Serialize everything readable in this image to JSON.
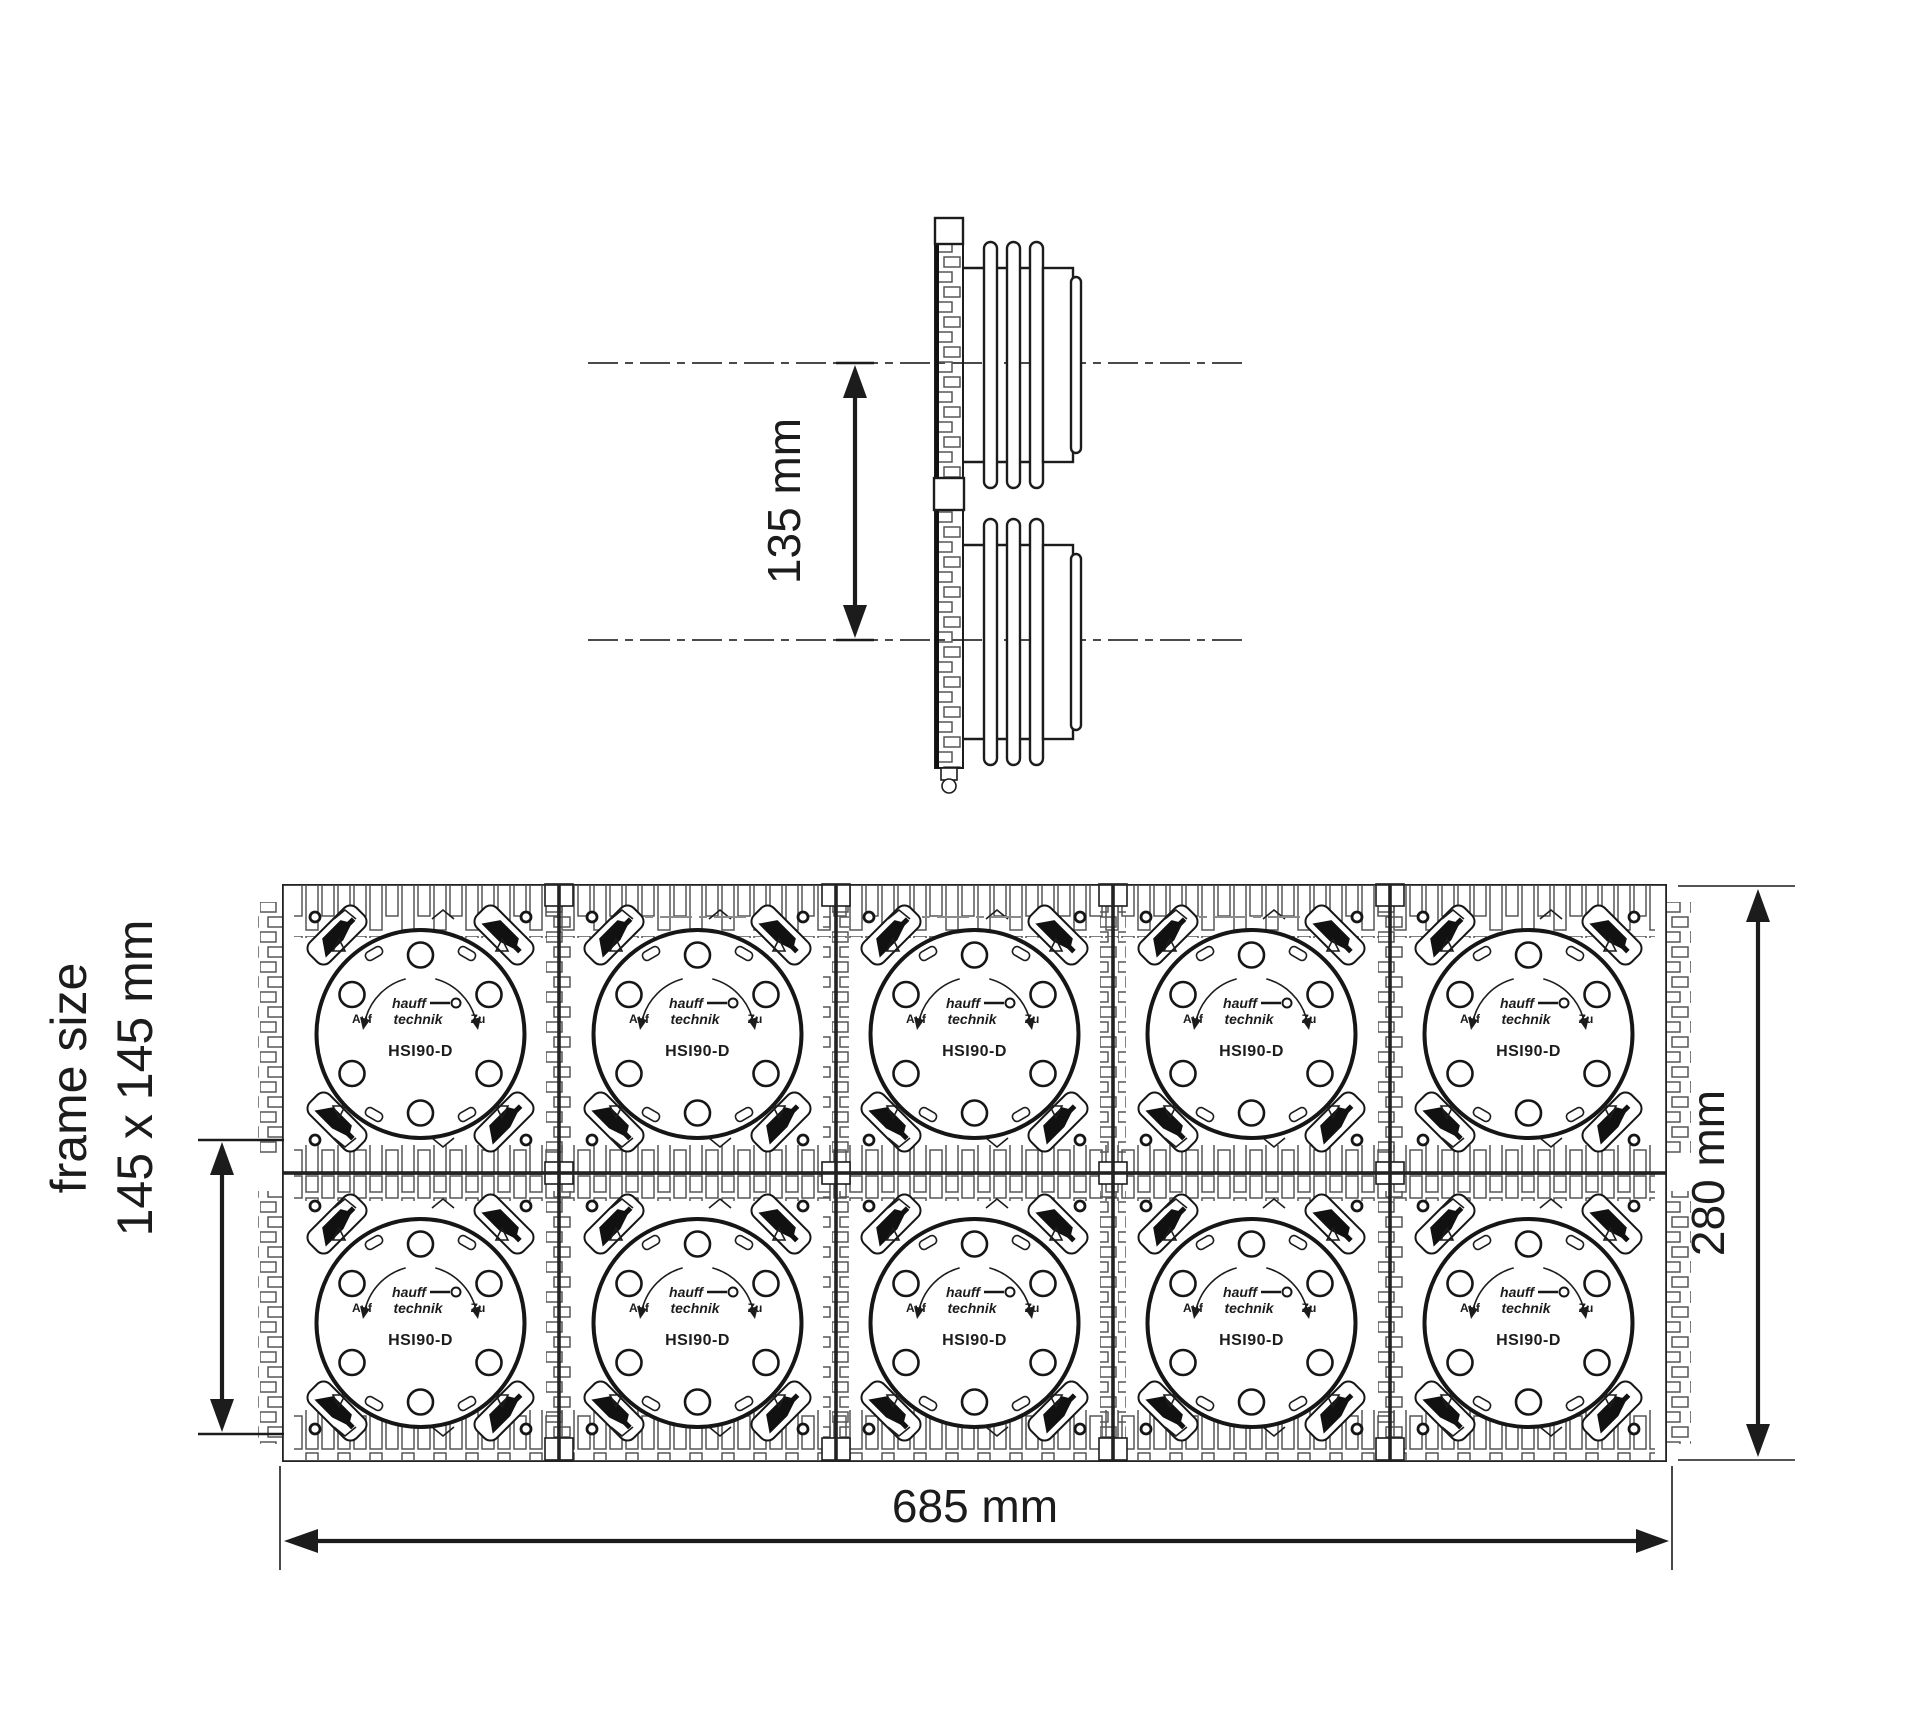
{
  "page": {
    "background": "#ffffff",
    "line_color": "#1c1c1c"
  },
  "side_view": {
    "dimension_label": "135 mm"
  },
  "front_view": {
    "frame_size_label": "frame size",
    "frame_size_value": "145 x 145 mm",
    "width_label": "685 mm",
    "height_label": "280 mm",
    "grid": {
      "rows": 2,
      "columns": 5
    },
    "cell": {
      "model": "HSI90-D",
      "open_label": "Auf",
      "close_label": "Zu",
      "brand_top": "hauff",
      "brand_bottom": "technik"
    }
  }
}
